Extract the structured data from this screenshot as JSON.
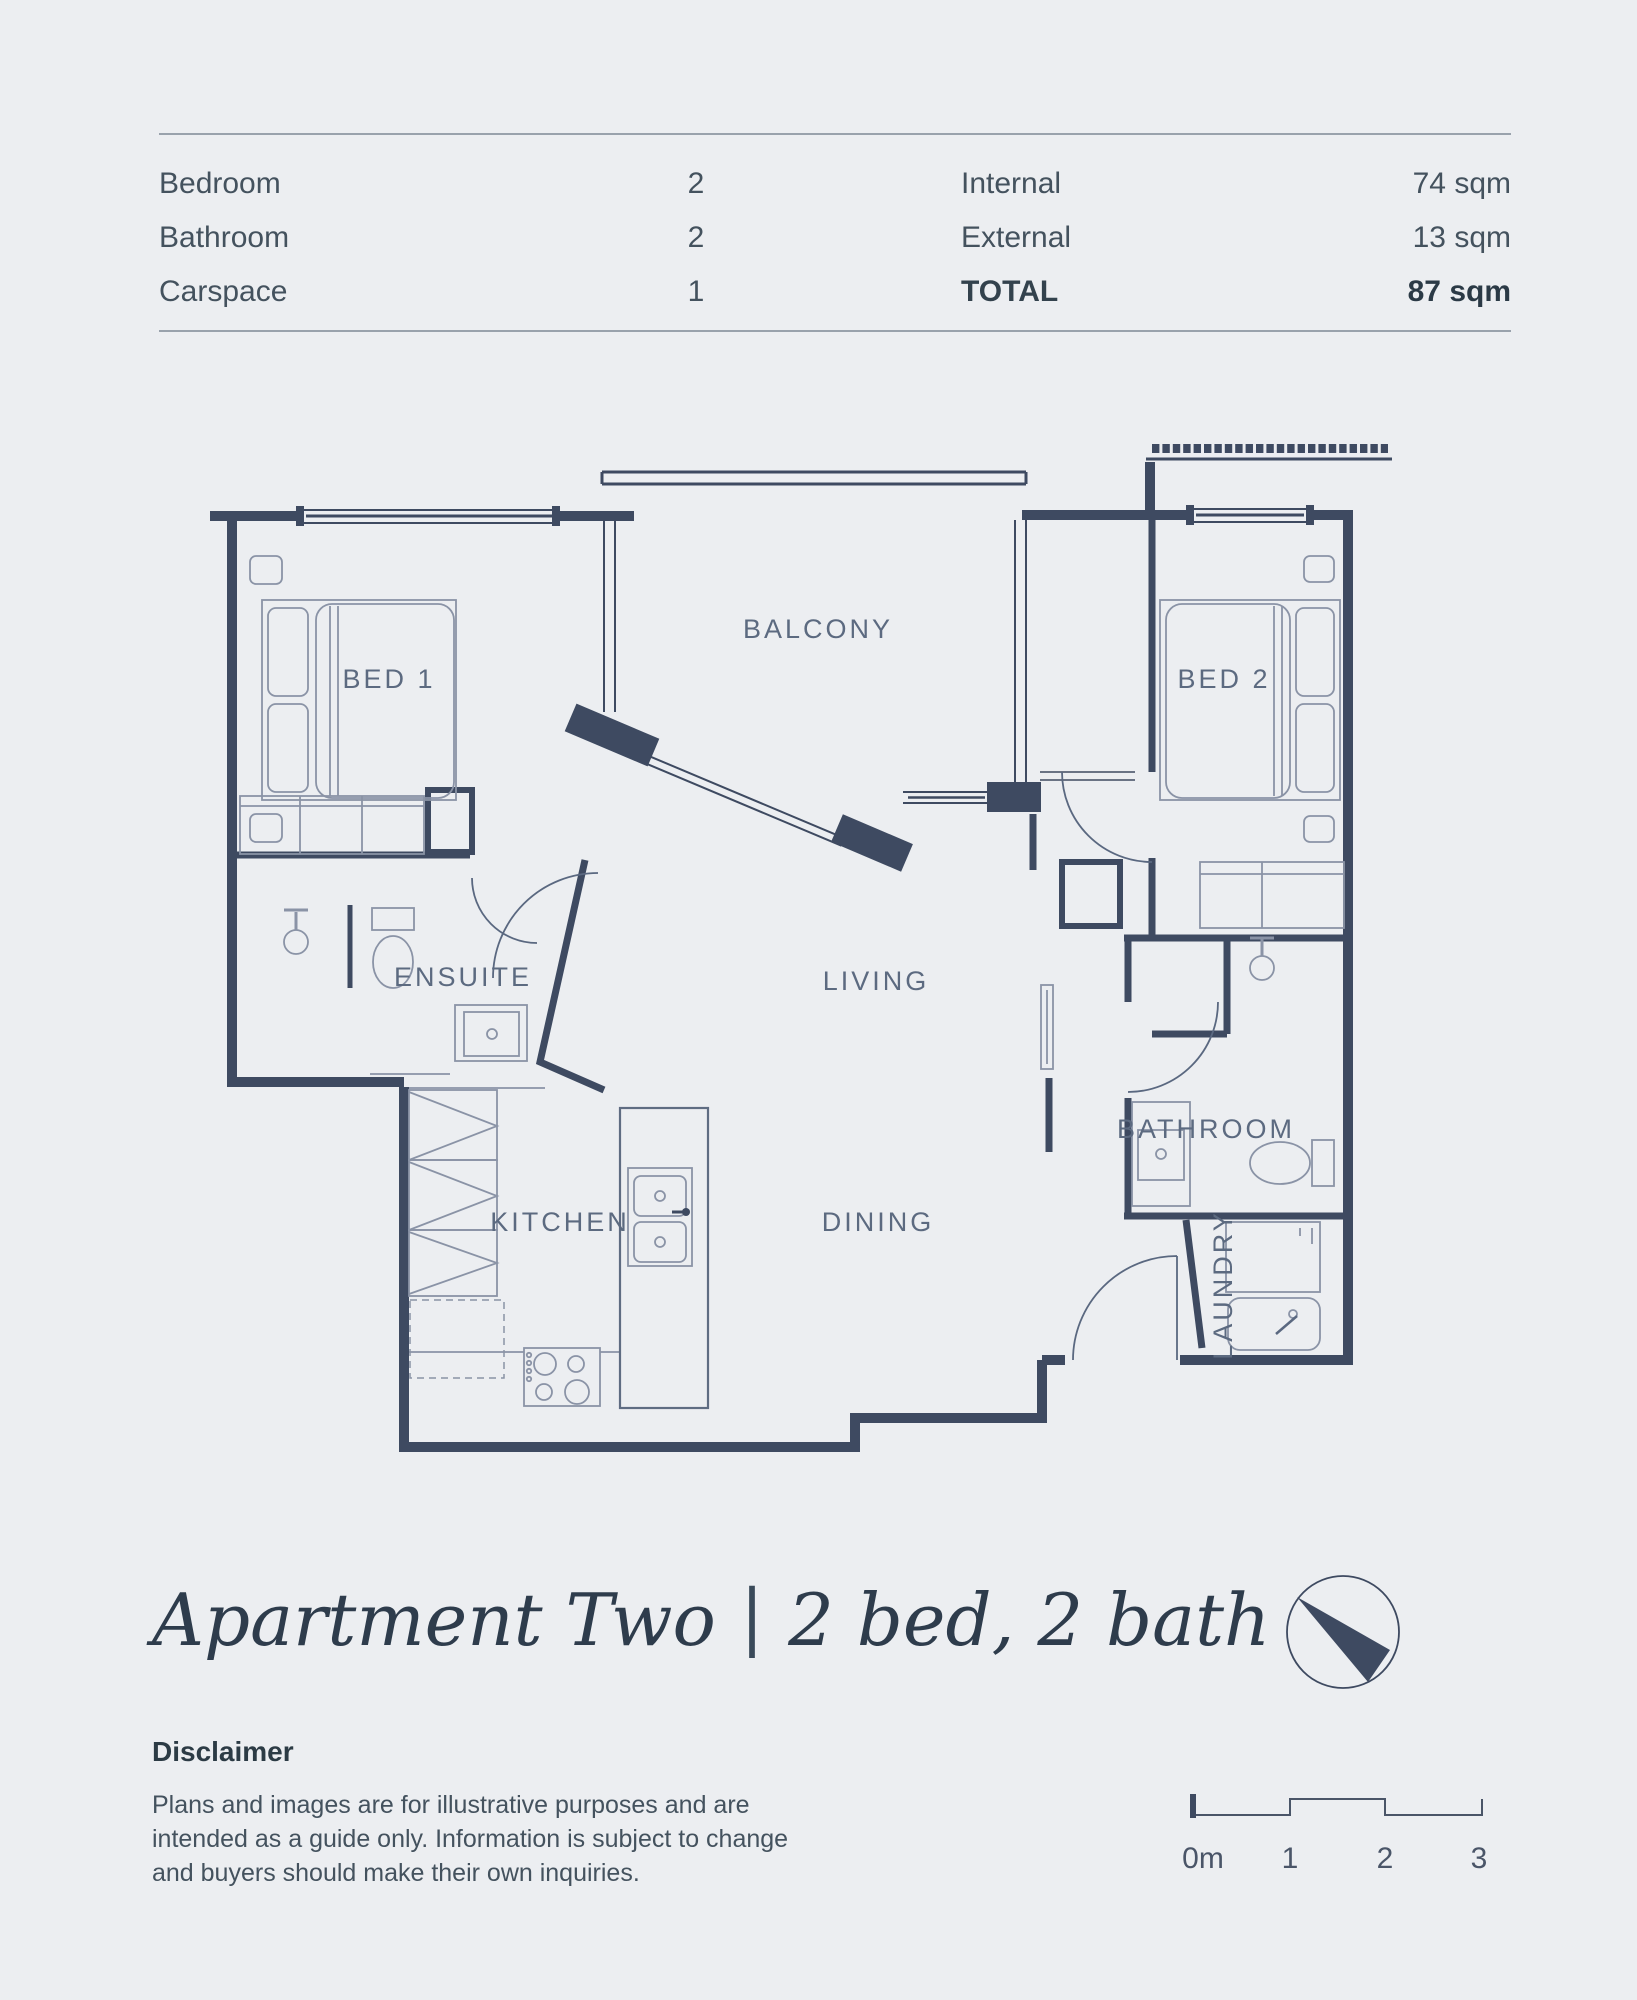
{
  "summary": {
    "rows": [
      {
        "label": "Bedroom",
        "count": "2",
        "metric": "Internal",
        "value": "74 sqm"
      },
      {
        "label": "Bathroom",
        "count": "2",
        "metric": "External",
        "value": "13 sqm"
      },
      {
        "label": "Carspace",
        "count": "1",
        "metric": "TOTAL",
        "value": "87 sqm"
      }
    ]
  },
  "plan": {
    "rooms": {
      "bed1": "BED 1",
      "balcony": "BALCONY",
      "bed2": "BED 2",
      "ensuite": "ENSUITE",
      "living": "LIVING",
      "bathroom": "BATHROOM",
      "kitchen": "KITCHEN",
      "dining": "DINING",
      "laundry": "LAUNDRY"
    }
  },
  "title": {
    "name": "Apartment Two",
    "separator": "|",
    "spec": "2 bed, 2 bath"
  },
  "disclaimer": {
    "heading": "Disclaimer",
    "lines": [
      "Plans and images are for illustrative purposes and are",
      "intended as a guide only. Information is subject to change",
      "and buyers should make their own inquiries."
    ]
  },
  "scale_bar": {
    "origin": "0m",
    "marks": [
      "1",
      "2",
      "3"
    ]
  },
  "colors": {
    "background": "#ECEEF1",
    "wall": "#3E4A61",
    "fixture": "#8A93A6",
    "label": "#5C6A80",
    "needle": "#3E4A61",
    "rule": "#99A2AC"
  }
}
